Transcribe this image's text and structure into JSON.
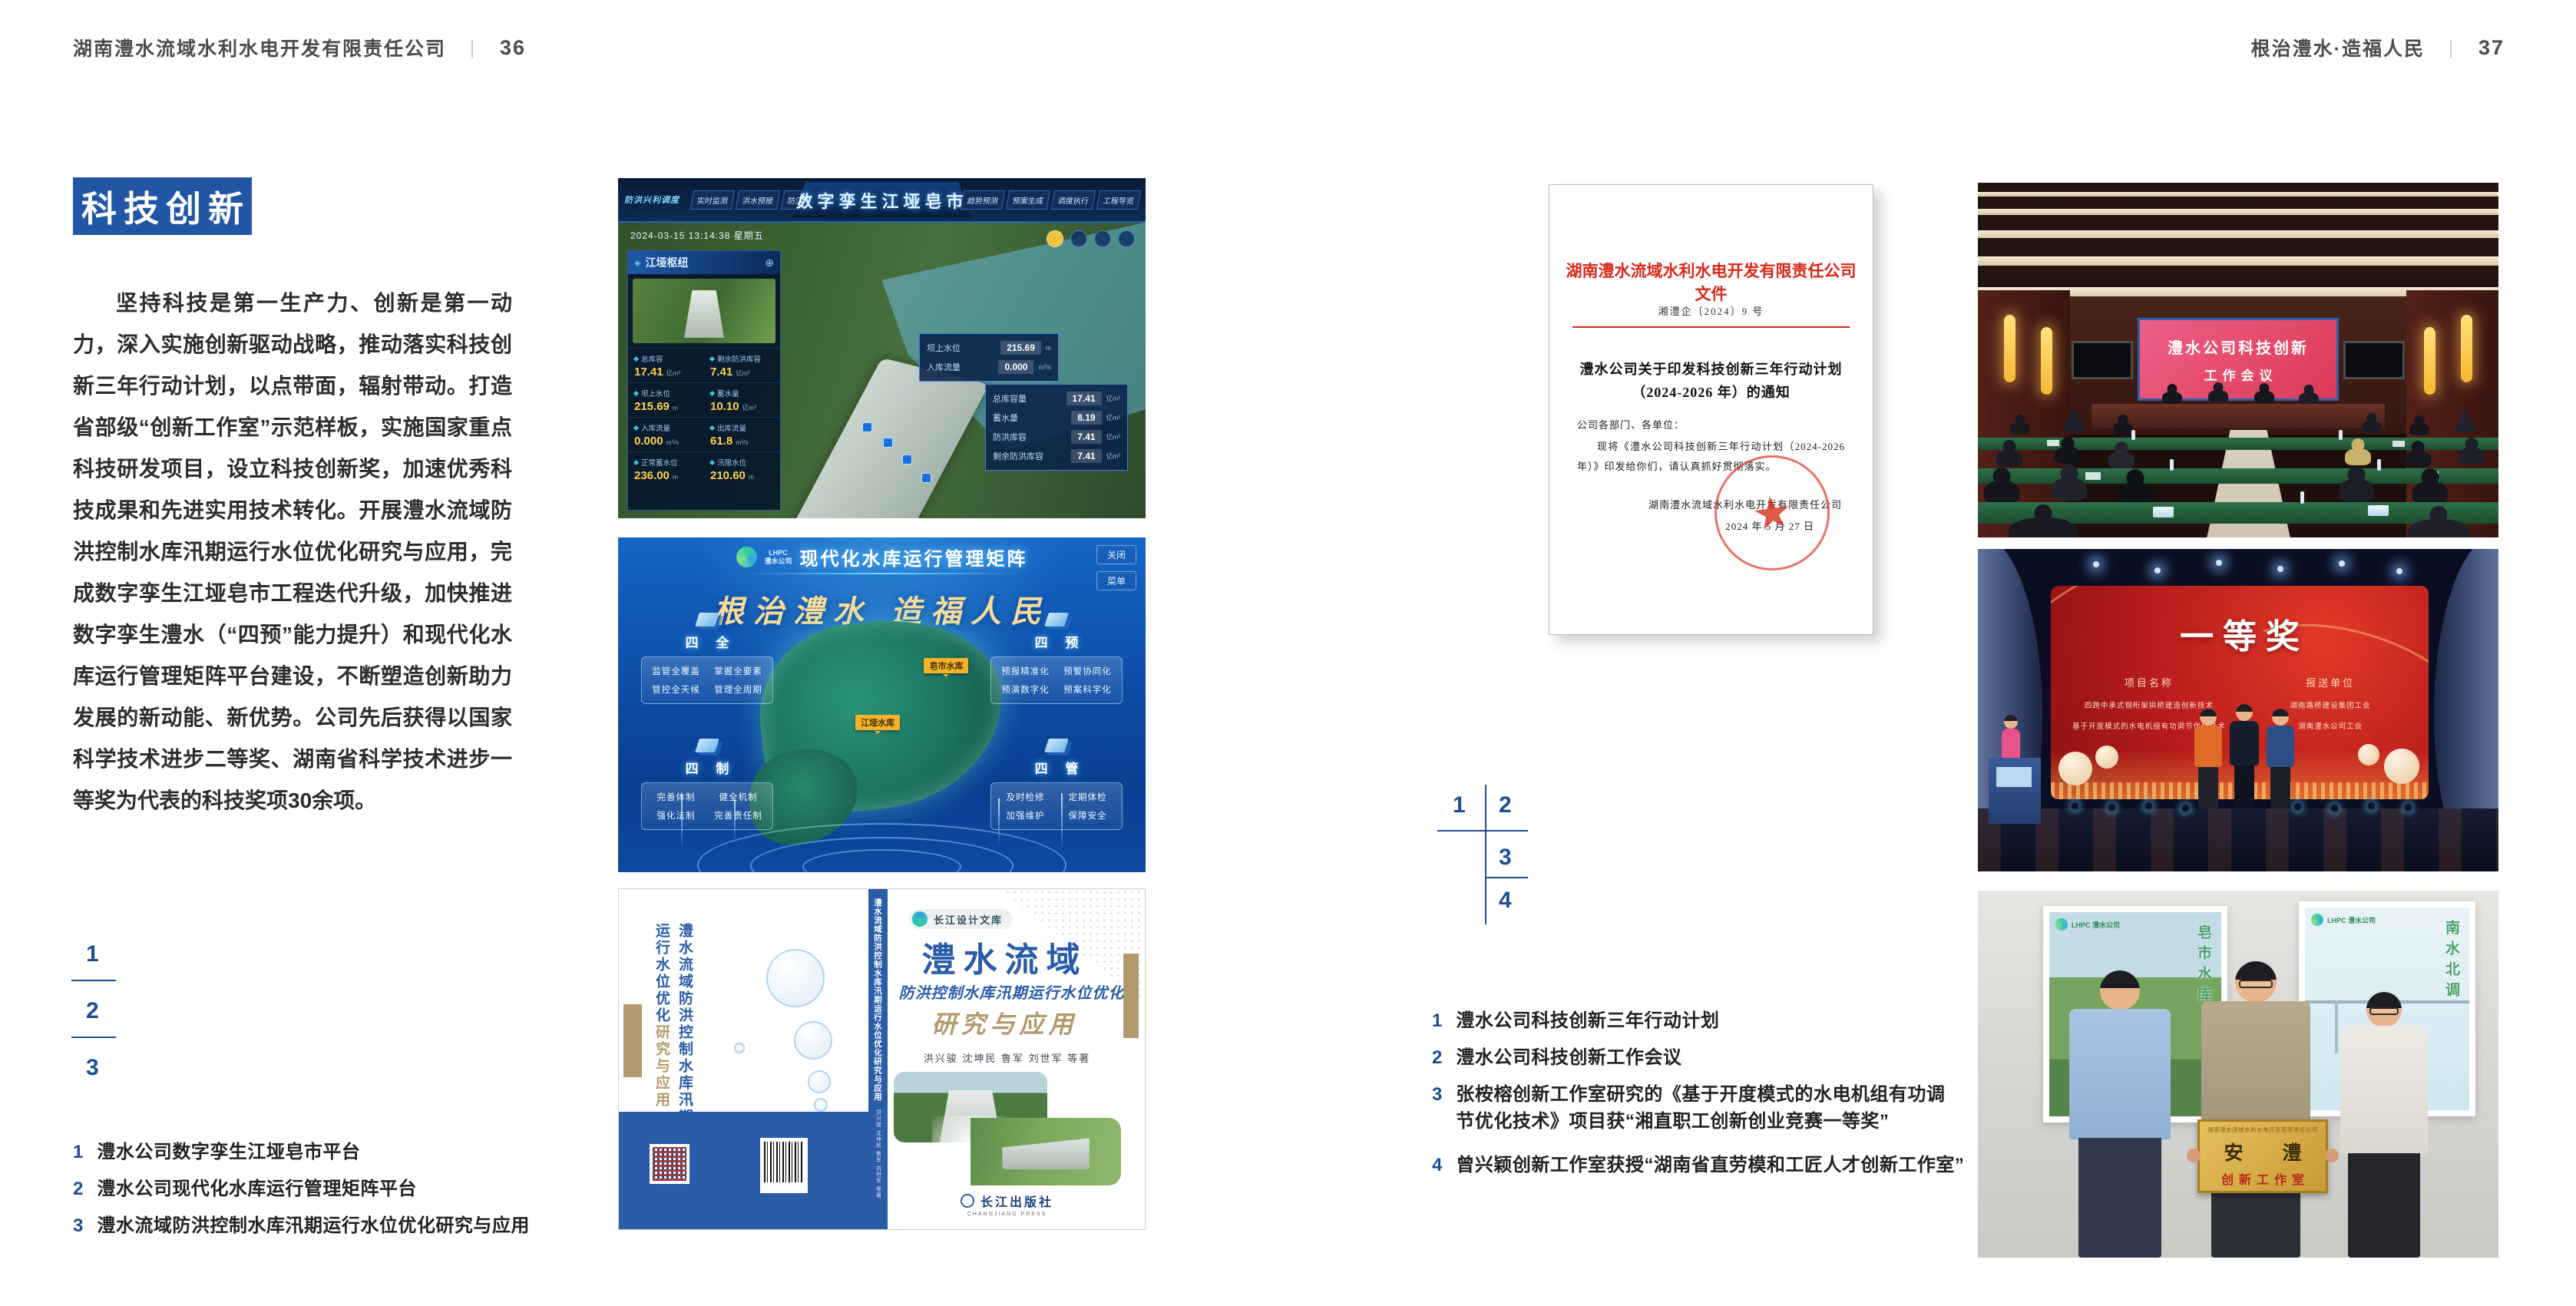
{
  "colors": {
    "accent_blue": "#2156a5",
    "index_blue": "#1d4f93",
    "doc_red": "#d8291a",
    "book_blue": "#2a5ca8",
    "book_tan": "#b39a6d",
    "screen_pink": "#e0507a",
    "award_red": "#b81c1c"
  },
  "page_left": {
    "header": {
      "company": "湖南澧水流域水利水电开发有限责任公司",
      "sep": "｜",
      "page_no": "36"
    },
    "badge": "科技创新",
    "paragraph": "坚持科技是第一生产力、创新是第一动力，深入实施创新驱动战略，推动落实科技创新三年行动计划，以点带面，辐射带动。打造省部级“创新工作室”示范样板，实施国家重点科技研发项目，设立科技创新奖，加速优秀科技成果和先进实用技术转化。开展澧水流域防洪控制水库汛期运行水位优化研究与应用，完成数字孪生江垭皂市工程迭代升级，加快推进数字孪生澧水（“四预”能力提升）和现代化水库运行管理矩阵平台建设，不断塑造创新助力发展的新动能、新优势。公司先后获得以国家科学技术进步二等奖、湖南省科学技术进步一等奖为代表的科技奖项30余项。",
    "figure_index": [
      "1",
      "2",
      "3"
    ],
    "captions": [
      {
        "num": "1",
        "text": "澧水公司数字孪生江垭皂市平台"
      },
      {
        "num": "2",
        "text": "澧水公司现代化水库运行管理矩阵平台"
      },
      {
        "num": "3",
        "text": "澧水流域防洪控制水库汛期运行水位优化研究与应用"
      }
    ],
    "fig1": {
      "title": "数字孪生江垭皂市",
      "corner_label": "防洪兴利调度",
      "tabs_left": [
        "实时监测",
        "洪水预报",
        "防汛预警"
      ],
      "tabs_right": [
        "趋势预测",
        "预案生成",
        "调度执行",
        "工程导览"
      ],
      "timestamp": "2024-03-15 13:14:38 星期五",
      "panel_title": "江垭枢纽",
      "stats": [
        {
          "label": "总库容",
          "value": "17.41",
          "unit": "亿m³"
        },
        {
          "label": "剩余防洪库容",
          "value": "7.41",
          "unit": "亿m³"
        },
        {
          "label": "坝上水位",
          "value": "215.69",
          "unit": "m"
        },
        {
          "label": "蓄水量",
          "value": "10.10",
          "unit": "亿m³"
        },
        {
          "label": "入库流量",
          "value": "0.000",
          "unit": "m³/s"
        },
        {
          "label": "出库流量",
          "value": "61.8",
          "unit": "m³/s"
        },
        {
          "label": "正常蓄水位",
          "value": "236.00",
          "unit": "m"
        },
        {
          "label": "汛限水位",
          "value": "210.60",
          "unit": "m"
        }
      ],
      "tooltip": [
        {
          "label": "坝上水位",
          "value": "215.69",
          "unit": "m"
        },
        {
          "label": "入库流量",
          "value": "0.000",
          "unit": "m³/s"
        }
      ],
      "infobox": [
        {
          "label": "总库容量",
          "value": "17.41",
          "unit": "亿m³"
        },
        {
          "label": "蓄水量",
          "value": "8.19",
          "unit": "亿m³"
        },
        {
          "label": "防洪库容",
          "value": "7.41",
          "unit": "亿m³"
        },
        {
          "label": "剩余防洪库容",
          "value": "7.41",
          "unit": "亿m³"
        }
      ]
    },
    "fig2": {
      "logo": "LHPC",
      "logo_sub": "澧水公司",
      "title": "现代化水库运行管理矩阵",
      "btn1": "关闭",
      "btn2": "菜单",
      "slogan": "根治澧水 造福人民",
      "groups": [
        {
          "title": "四 全",
          "items": [
            "监管全覆盖",
            "掌握全要素",
            "管控全天候",
            "管理全周期"
          ]
        },
        {
          "title": "四 预",
          "items": [
            "预报精准化",
            "预警协同化",
            "预演数字化",
            "预案科学化"
          ]
        },
        {
          "title": "四 制",
          "items": [
            "完善体制",
            "健全机制",
            "强化法制",
            "完善责任制"
          ]
        },
        {
          "title": "四 管",
          "items": [
            "及时检修",
            "定期体检",
            "加强维护",
            "保障安全"
          ]
        }
      ],
      "map_labels": [
        "江垭水库",
        "皂市水库"
      ]
    },
    "fig3": {
      "series": "长江设计文库",
      "title_line1": "澧水流域",
      "title_line2": "防洪控制水库汛期运行水位优化",
      "title_line3": "研究与应用",
      "authors": "洪兴骏 沈坤民 鲁军 刘世军 等著",
      "publisher": "长江出版社",
      "publisher_en": "CHANGJIANG PRESS",
      "spine_title": "澧水流域防洪控制水库汛期运行水位优化研究与应用"
    }
  },
  "page_right": {
    "header": {
      "motto": "根治澧水·造福人民",
      "sep": "｜",
      "page_no": "37"
    },
    "figure_index": [
      "1",
      "2",
      "3",
      "4"
    ],
    "captions": [
      {
        "num": "1",
        "text": "澧水公司科技创新三年行动计划"
      },
      {
        "num": "2",
        "text": "澧水公司科技创新工作会议"
      },
      {
        "num": "3",
        "text": "张桉榕创新工作室研究的《基于开度模式的水电机组有功调节优化技术》项目获“湘直职工创新创业竞赛一等奖”"
      },
      {
        "num": "4",
        "text": "曾兴颖创新工作室获授“湖南省直劳模和工匠人才创新工作室”"
      }
    ],
    "document": {
      "heading": "湖南澧水流域水利水电开发有限责任公司文件",
      "doc_no": "湘澧企〔2024〕9 号",
      "title_line1": "澧水公司关于印发科技创新三年行动计划",
      "title_line2": "（2024-2026 年）的通知",
      "salutation": "公司各部门、各单位：",
      "body": "现将《澧水公司科技创新三年行动计划（2024-2026 年）》印发给你们，请认真抓好贯彻落实。",
      "signer": "湖南澧水流域水利水电开发有限责任公司",
      "date": "2024 年 5 月 27 日"
    },
    "meeting": {
      "screen_line1": "澧水公司科技创新",
      "screen_line2": "工作会议"
    },
    "award": {
      "screen_title": "一等奖",
      "col1_header": "项目名称",
      "col2_header": "报送单位",
      "projects": [
        "四跨中承式钢桁架拱桥建造创新技术",
        "基于开度模式的水电机组有功调节优化技术"
      ],
      "units": [
        "湖南路桥建设集团工会",
        "湖南澧水公司工会"
      ]
    },
    "group": {
      "plaque_top": "湖南澧水流域水利水电开发有限责任公司",
      "plaque_main": "安 澧",
      "plaque_sub": "创新工作室",
      "poster_left_logo": "LHPC 澧水公司",
      "poster_left_text": "皂市水库",
      "poster_right_logo": "LHPC 澧水公司",
      "poster_right_text": "南水北调"
    }
  }
}
